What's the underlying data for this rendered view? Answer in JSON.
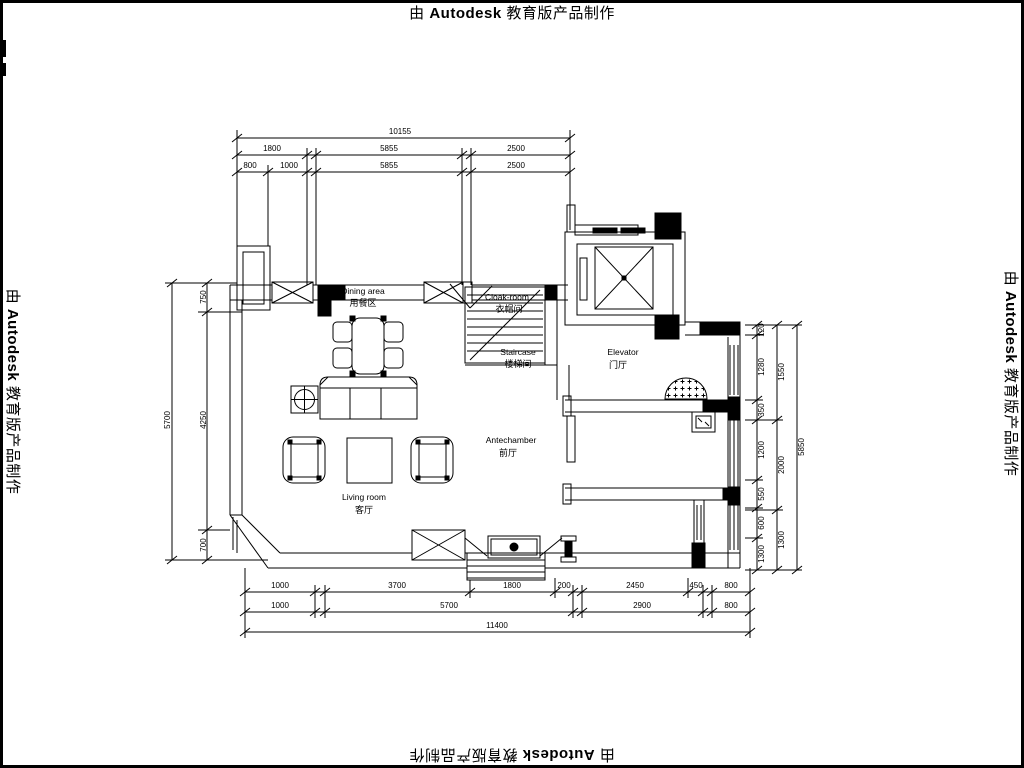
{
  "watermark": {
    "prefix": "由",
    "brand": "Autodesk",
    "suffix": "教育版产品制作"
  },
  "rooms": {
    "dining": {
      "en": "Dining area",
      "zh": "用餐区"
    },
    "cloakroom": {
      "en": "Cloak-room",
      "zh": "衣帽间"
    },
    "staircase": {
      "en": "Staircase",
      "zh": "楼梯间"
    },
    "elevator": {
      "en": "Elevator",
      "zh": "门厅"
    },
    "antechamber": {
      "en": "Antechamber",
      "zh": "前厅"
    },
    "living": {
      "en": "Living room",
      "zh": "客厅"
    }
  },
  "dims": {
    "top": {
      "total": "10155",
      "r2a": "1800",
      "r2b": "5855",
      "r2c": "2500",
      "r3a": "800",
      "r3b": "1000",
      "r3c": "5855",
      "r3d": "2500"
    },
    "left": {
      "total": "5700",
      "a": "750",
      "b": "4250",
      "c": "700"
    },
    "right": {
      "outer": "5850",
      "m1": "1550",
      "m2": "2000",
      "m3": "1300",
      "i1": "120",
      "i2": "1280",
      "i3": "350",
      "i4": "1200",
      "i5": "550",
      "i6": "600",
      "i7": "1300"
    },
    "bottom": {
      "r1a": "1000",
      "r1b": "3700",
      "r1c": "1800",
      "r1d": "200",
      "r1e": "2450",
      "r1f": "450",
      "r1g": "800",
      "r2a": "1000",
      "r2b": "5700",
      "r2c": "2900",
      "r2d": "800",
      "total": "11400"
    }
  },
  "colors": {
    "line": "#000000",
    "background": "#ffffff"
  }
}
